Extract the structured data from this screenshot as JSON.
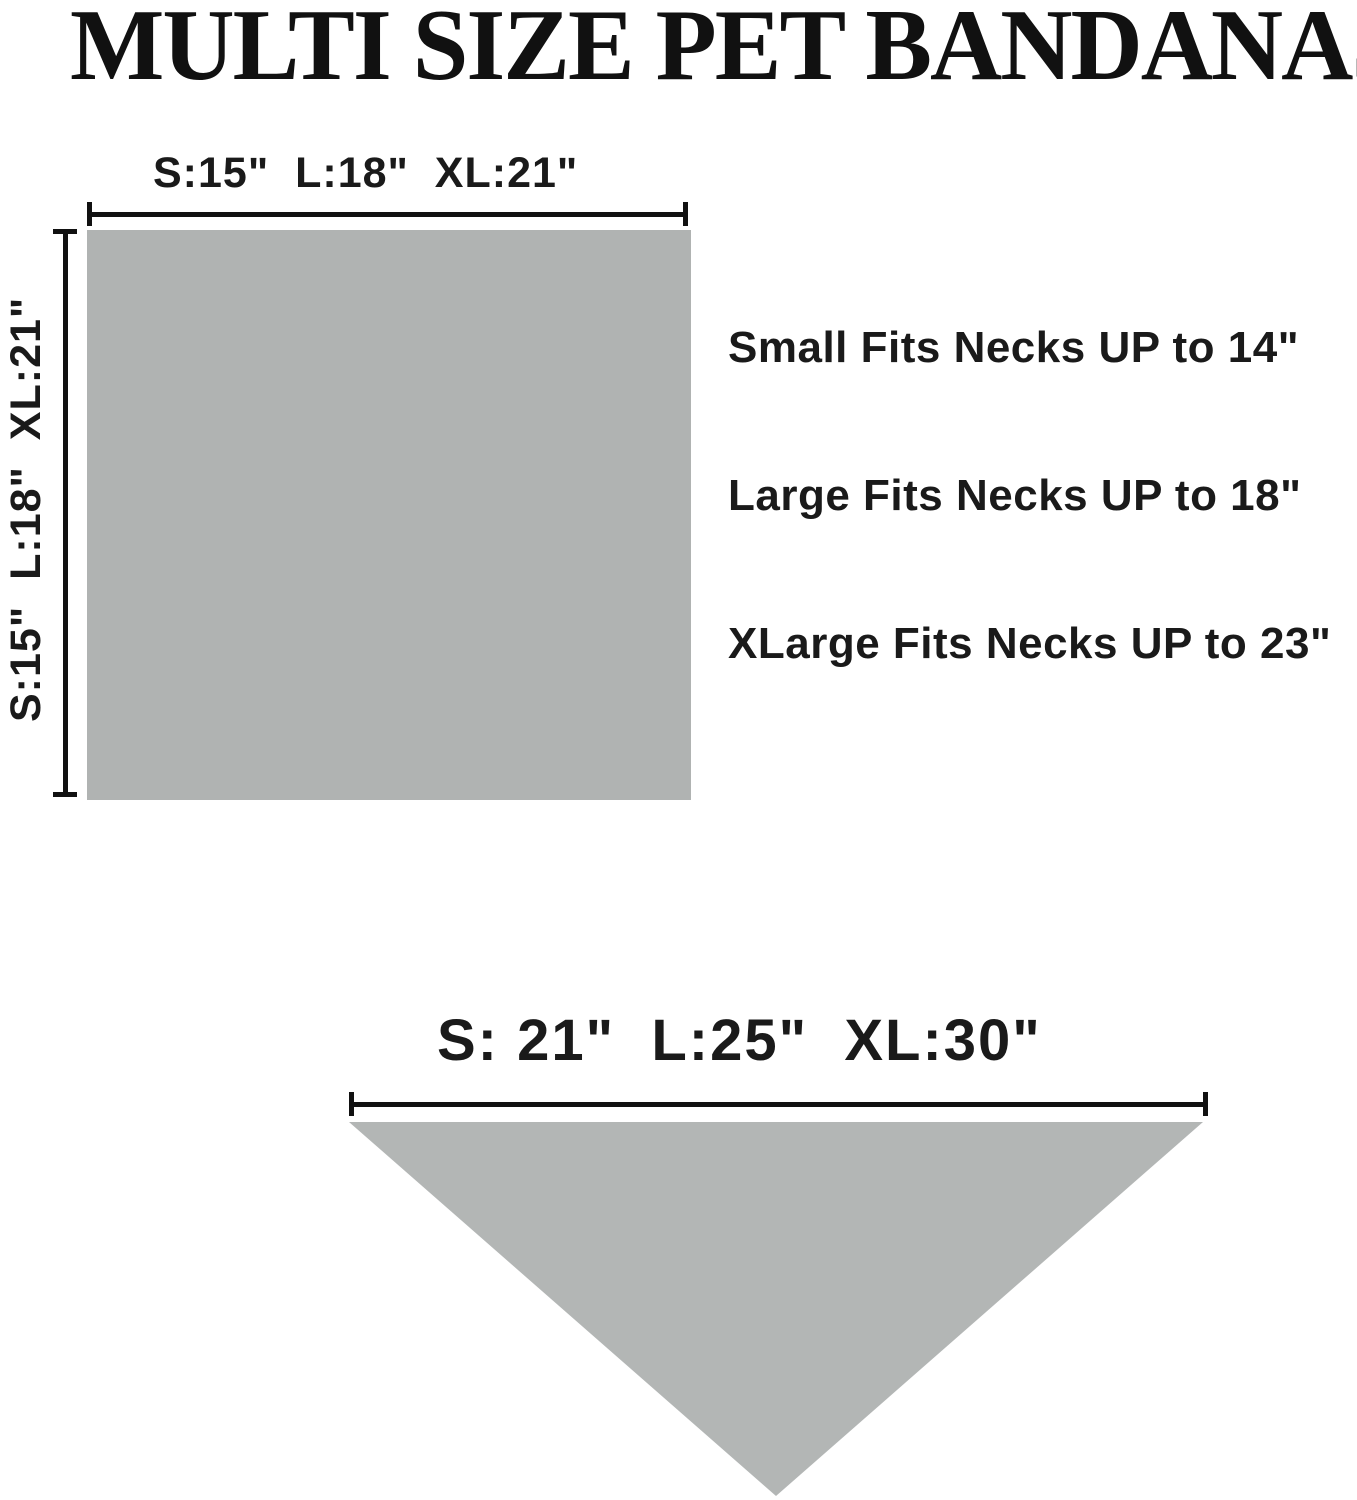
{
  "title": "MULTI SIZE PET BANDANAS",
  "square_diagram": {
    "shape": "square",
    "width_label": "S:15\"  L:18\"  XL:21\"",
    "height_label": "S:15\"  L:18\"  XL:21\""
  },
  "fit_notes": [
    "Small Fits Necks UP to 14\"",
    "Large Fits Necks UP to 18\"",
    "XLarge Fits Necks UP to 23\""
  ],
  "triangle_diagram": {
    "shape": "triangle",
    "width_label": "S: 21\"  L:25\"  XL:30\""
  },
  "colors": {
    "square_gray": "#b0b3b2",
    "triangle_gray": "#b3b6b5",
    "text_black": "#111111",
    "background": "#ffffff"
  }
}
